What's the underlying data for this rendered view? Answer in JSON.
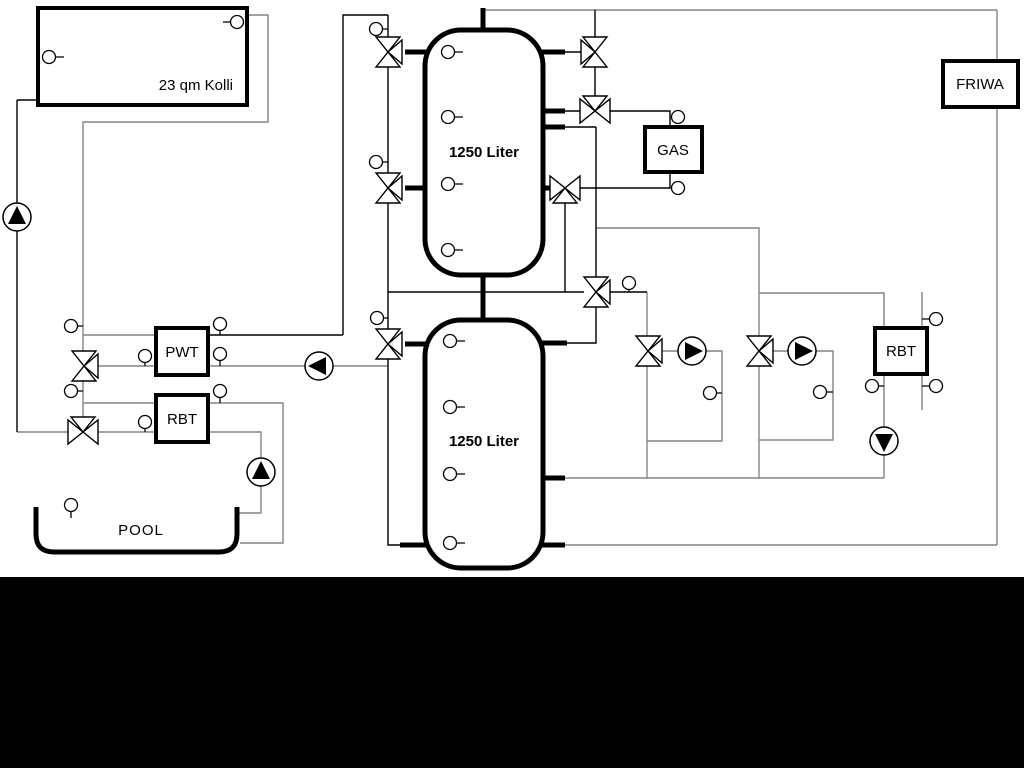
{
  "diagram": {
    "labels": {
      "collector": "23 qm Kolli",
      "tank_top": "1250 Liter",
      "tank_bottom": "1250 Liter",
      "gas": "GAS",
      "friwa": "FRIWA",
      "pwt": "PWT",
      "rbt_left": "RBT",
      "rbt_right": "RBT",
      "pool": "POOL"
    },
    "colors": {
      "pipe_gray": "#848484",
      "pipe_black": "#000000",
      "component_fill": "#ffffff",
      "footer_band": "#000000"
    },
    "icons": {
      "pump-icon": "circle with solid directional triangle",
      "three-way-valve-icon": "double-triangle bowtie with third port triangle",
      "temperature-sensor-icon": "small circle with stem"
    }
  }
}
